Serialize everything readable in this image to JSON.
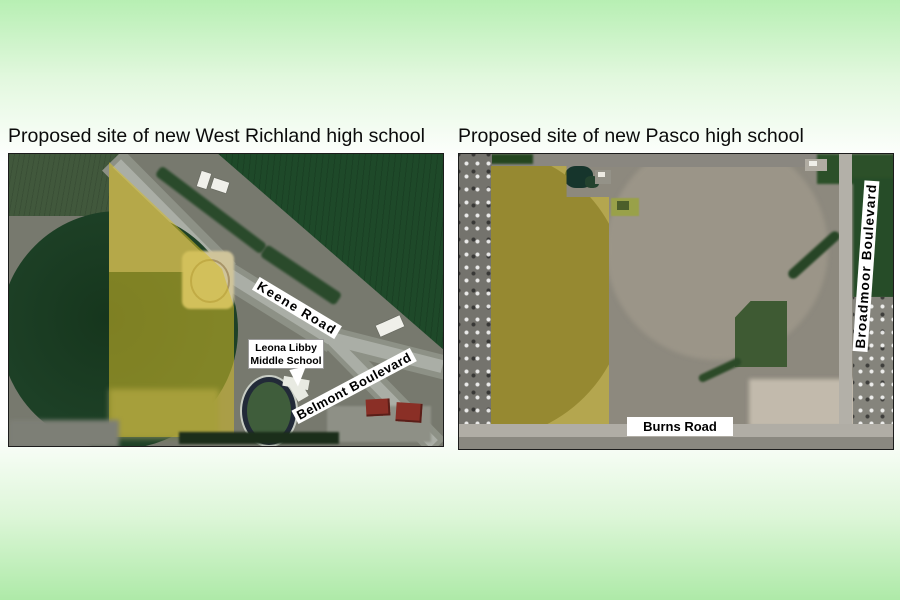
{
  "page": {
    "background": {
      "top_color": "#b7efb3",
      "middle_color": "#ffffff",
      "bottom_color": "#aeeaa8"
    }
  },
  "panels": {
    "left": {
      "title": "Proposed site of new West Richland high school",
      "map_labels": {
        "road_1": "Keene Road",
        "road_2": "Belmont Boulevard",
        "school_box_line1": "Leona Libby",
        "school_box_line2": "Middle School"
      }
    },
    "right": {
      "title": "Proposed site of new Pasco high school",
      "map_labels": {
        "road_1": "Burns Road",
        "road_2": "Broadmoor Boulevard"
      }
    }
  },
  "theme": {
    "site_highlight_hex": "#d6be28",
    "site_highlight_fill": "rgba(214,190,40,0.55)",
    "map_label_bg": "#ffffff",
    "map_label_text": "#000000",
    "title_text": "#0b0b0b"
  }
}
